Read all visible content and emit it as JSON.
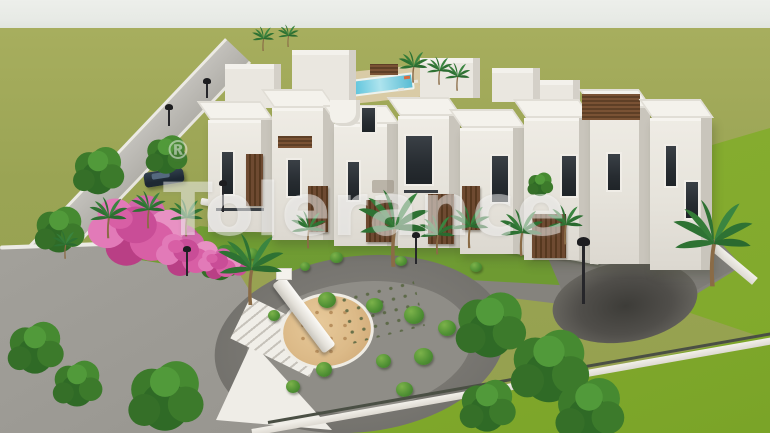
{
  "scene_type": "3D architectural render, aerial view of a residential villa complex",
  "watermark": {
    "text": "Tolerance",
    "registered_mark": "®"
  },
  "palette": {
    "sky": "#eaece8",
    "field_green": "#9aa454",
    "front_lawn_green": "#85ab2f",
    "garden_green": "#6f9a33",
    "building_white": "#ece9e2",
    "building_shadow": "#c9c5bc",
    "wood_brown": "#6e4a31",
    "window_dark": "#2e3338",
    "asphalt_gray": "#8a8883",
    "plaza_dark_gray": "#6e6d68",
    "sand_tan": "#ddbd8c",
    "pool_blue": "#5ec4dc",
    "bougainvillea_pink": "#d85fa5",
    "tree_green": "#3f7d2c",
    "lamp_black": "#26262a"
  },
  "scene_elements": {
    "buildings": "row of white two-storey villas with wooden slat accents and roof terraces",
    "amenities": [
      "swimming pool",
      "playground plaza with sand pit and slide",
      "skate bowl",
      "parking area",
      "white garden walkways"
    ],
    "vegetation": [
      "palm trees",
      "leafy trees",
      "topiary bushes",
      "pink bougainvillea"
    ],
    "street_furniture": [
      "street lamps",
      "parked car",
      "boundary fence"
    ]
  }
}
